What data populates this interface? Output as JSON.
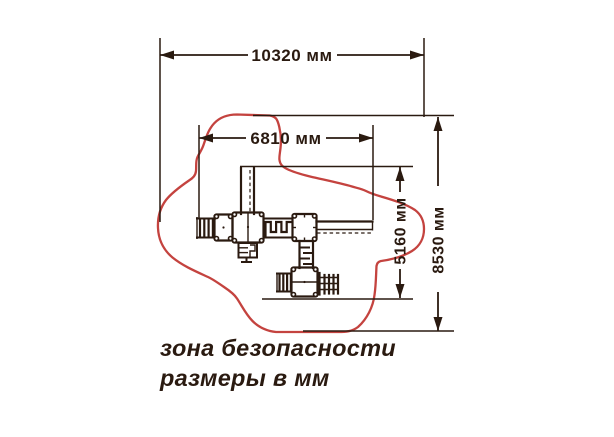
{
  "colors": {
    "ink": "#2a1a10",
    "red": "#c4433f",
    "background": "#ffffff"
  },
  "dimensions": {
    "total_width": {
      "label": "10320 мм"
    },
    "equipment_width": {
      "label": "6810 мм"
    },
    "equipment_depth": {
      "label": "5160 мм"
    },
    "total_depth": {
      "label": "8530 мм"
    }
  },
  "caption": {
    "line1": "зона безопасности",
    "line2": "размеры в мм"
  }
}
